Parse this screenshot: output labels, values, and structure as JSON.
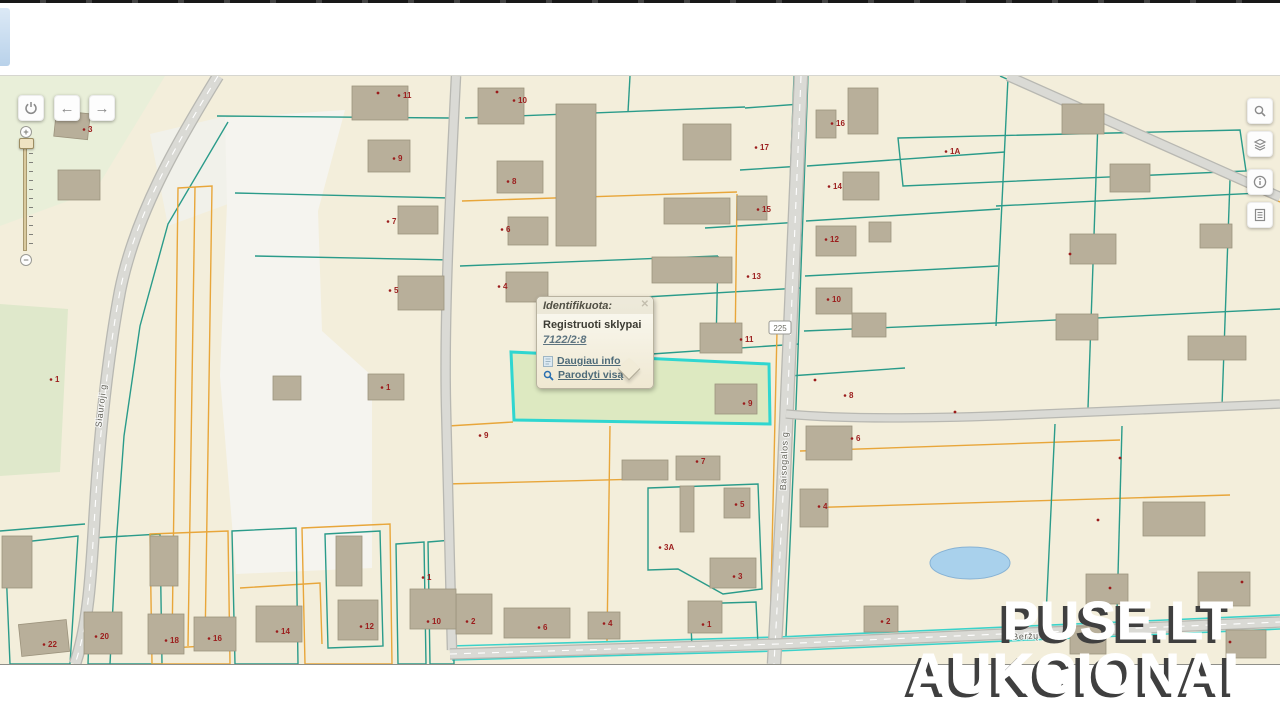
{
  "popup": {
    "title": "Identifikuota:",
    "close_label": "✕",
    "layer_name": "Registruoti sklypai",
    "parcel_id": "7122/2:8",
    "links": [
      {
        "icon": "page-info-icon",
        "label": "Daugiau info"
      },
      {
        "icon": "magnifier-icon",
        "label": "Parodyti visą"
      }
    ]
  },
  "watermark": {
    "line1": "PUSE.LT",
    "line2": "AUKCIONAI"
  },
  "controls": {
    "nav_buttons": [
      {
        "icon": "power-icon"
      },
      {
        "icon": "arrow-left-icon"
      },
      {
        "icon": "arrow-right-icon"
      }
    ],
    "zoom_slider": {
      "plus_label": "+",
      "minus_label": "−"
    },
    "right_toolbar": [
      {
        "icon": "search-icon"
      },
      {
        "icon": "layers-icon"
      },
      {
        "icon": "info-icon"
      },
      {
        "icon": "results-list-icon"
      }
    ]
  },
  "map": {
    "street_labels": [
      {
        "t": "Siauroji g",
        "x": 104,
        "y": 330,
        "r": -83
      },
      {
        "t": "Baisogalos g",
        "x": 787,
        "y": 385,
        "r": -88
      },
      {
        "t": "Beržų g",
        "x": 1030,
        "y": 563,
        "r": -3
      }
    ],
    "road_shield": {
      "t": "225",
      "x": 780,
      "y": 252
    },
    "selected_parcel_id": "7122/2:8"
  },
  "colors": {
    "base": "#f3eedb",
    "teal": "#2a9b8a",
    "orange": "#e8a63a",
    "cyan": "#3bd2ca",
    "road_fill": "#dadad5",
    "road_edge": "#b8b8b2",
    "building": "#b8af9a",
    "building_stroke": "#9c937d",
    "number": "#9b1c1c",
    "selection_fill": "#d8e7bc",
    "selection_stroke": "#2fd6d0",
    "pond": "#a9d1ec"
  },
  "map_geometry": {
    "zones": [
      {
        "points": "0,0 165,0 95,115 0,150",
        "fill": "#e9efd9"
      },
      {
        "points": "0,228 68,233 60,396 0,400",
        "fill": "#dfe8cb"
      },
      {
        "points": "150,58 226,40 228,128 168,150",
        "fill": "#f1f1ea"
      },
      {
        "points": "225,42 345,34 318,135 322,255 372,300 372,492 236,498 220,300 227,128",
        "fill": "#f5f4ef"
      }
    ],
    "parcels": [
      {
        "points": "898,62 1240,54 1246,95 903,110",
        "c": "teal"
      },
      {
        "points": "648,412 758,408 762,513 723,518 678,493 648,494",
        "c": "teal"
      },
      {
        "points": "690,528 756,526 758,569 692,571",
        "c": "teal"
      },
      {
        "points": "325,458 380,455 383,570 328,572",
        "c": "teal"
      },
      {
        "points": "178,112 212,110 205,570 172,572",
        "c": "orange"
      },
      {
        "points": "5,468 78,460 70,588 10,588",
        "c": "teal"
      },
      {
        "points": "92,462 160,458 162,588 88,588",
        "c": "teal"
      },
      {
        "points": "150,458 228,455 230,588 152,588",
        "c": "orange"
      },
      {
        "points": "232,455 296,452 298,588 235,588",
        "c": "teal"
      },
      {
        "points": "302,452 390,448 392,588 305,588",
        "c": "orange"
      },
      {
        "points": "396,468 424,466 426,588 398,588",
        "c": "teal"
      },
      {
        "points": "428,466 452,464 454,588 430,588",
        "c": "teal"
      }
    ],
    "lines": [
      {
        "p": "807,90 1005,76"
      },
      {
        "p": "806,145 1000,133"
      },
      {
        "p": "805,200 998,190"
      },
      {
        "p": "804,255 995,247"
      },
      {
        "p": "1008,2 996,250"
      },
      {
        "p": "996,130 1280,116"
      },
      {
        "p": "995,247 1280,233"
      },
      {
        "p": "745,32 801,28"
      },
      {
        "p": "740,94 802,90"
      },
      {
        "p": "705,152 801,146"
      },
      {
        "p": "645,221 800,212"
      },
      {
        "p": "622,280 799,268"
      },
      {
        "p": "737,118 735,276",
        "c": "orange"
      },
      {
        "p": "465,42 745,31"
      },
      {
        "p": "462,125 737,116",
        "c": "orange"
      },
      {
        "p": "460,190 718,180"
      },
      {
        "p": "630,0 628,36"
      },
      {
        "p": "718,180 716,268"
      },
      {
        "p": "448,350 513,346",
        "c": "orange"
      },
      {
        "p": "610,350 607,565",
        "c": "orange"
      },
      {
        "p": "446,408 645,403",
        "c": "orange"
      },
      {
        "p": "240,512 320,507 322,568",
        "c": "orange"
      },
      {
        "p": "195,111 188,570",
        "c": "orange"
      },
      {
        "p": "794,0 782,330 777,570"
      },
      {
        "p": "808,0 796,330 786,560"
      },
      {
        "p": "777,255 770,560",
        "c": "orange"
      },
      {
        "p": "789,300 905,292"
      },
      {
        "p": "800,375 1120,364",
        "c": "orange"
      },
      {
        "p": "800,432 1230,419",
        "c": "orange"
      },
      {
        "p": "1122,350 1117,536"
      },
      {
        "p": "1055,348 1046,540"
      },
      {
        "p": "1098,44 1088,332"
      },
      {
        "p": "1230,104 1222,330"
      },
      {
        "p": "1012,6 1280,126",
        "c": "orange"
      },
      {
        "p": "1000,0 1274,120"
      },
      {
        "p": "217,40 450,42"
      },
      {
        "p": "235,117 450,122"
      },
      {
        "p": "255,180 452,184"
      },
      {
        "p": "228,46 168,148 140,250 124,360 116,470 110,588"
      },
      {
        "p": "450,570 778,561 1280,539",
        "c": "cyan"
      },
      {
        "p": "452,584 778,575 1280,553",
        "c": "cyan"
      },
      {
        "p": "0,455 85,448"
      }
    ],
    "roads": [
      {
        "d": "M218,0 C175,70 135,140 120,215 C106,290 98,380 94,450 C91,500 88,550 75,588",
        "w": 10,
        "center": true
      },
      {
        "d": "M456,0 C450,120 444,240 446,330 C448,420 450,500 452,574",
        "w": 8,
        "center": false
      },
      {
        "d": "M801,0 C795,150 789,300 783,420 C779,500 776,550 774,588",
        "w": 12,
        "center": true
      },
      {
        "d": "M450,578 L778,568 C950,560 1120,553 1280,546",
        "w": 9,
        "center": true
      },
      {
        "d": "M786,338 C850,344 950,342 1020,339 C1120,335 1220,330 1280,328",
        "w": 7,
        "center": false
      },
      {
        "d": "M1008,0 L1280,121",
        "w": 8,
        "center": false
      }
    ],
    "pond": {
      "cx": 970,
      "cy": 487,
      "rx": 40,
      "ry": 16
    },
    "selection": {
      "points": "511,276 769,288 770,348 514,344"
    },
    "buildings": [
      [
        55,
        36,
        34,
        26,
        6
      ],
      [
        58,
        94,
        42,
        30,
        0
      ],
      [
        352,
        10,
        56,
        34,
        0
      ],
      [
        478,
        12,
        46,
        36,
        0
      ],
      [
        556,
        28,
        40,
        142,
        0
      ],
      [
        368,
        64,
        42,
        32,
        0
      ],
      [
        497,
        85,
        46,
        32,
        0
      ],
      [
        398,
        130,
        40,
        28,
        0
      ],
      [
        508,
        141,
        40,
        28,
        0
      ],
      [
        398,
        200,
        46,
        34,
        0
      ],
      [
        506,
        196,
        42,
        30,
        0
      ],
      [
        683,
        48,
        48,
        36,
        0
      ],
      [
        664,
        122,
        66,
        26,
        0
      ],
      [
        737,
        120,
        30,
        24,
        0
      ],
      [
        652,
        181,
        80,
        26,
        0
      ],
      [
        700,
        247,
        42,
        30,
        0
      ],
      [
        848,
        12,
        30,
        46,
        0
      ],
      [
        816,
        34,
        20,
        28,
        0
      ],
      [
        843,
        96,
        36,
        28,
        0
      ],
      [
        816,
        150,
        40,
        30,
        0
      ],
      [
        869,
        146,
        22,
        20,
        0
      ],
      [
        816,
        212,
        36,
        26,
        0
      ],
      [
        852,
        237,
        34,
        24,
        0
      ],
      [
        1062,
        28,
        42,
        30,
        0
      ],
      [
        1110,
        88,
        40,
        28,
        0
      ],
      [
        1070,
        158,
        46,
        30,
        0
      ],
      [
        1056,
        238,
        42,
        26,
        0
      ],
      [
        1188,
        260,
        58,
        24,
        0
      ],
      [
        1200,
        148,
        32,
        24,
        0
      ],
      [
        715,
        308,
        42,
        30,
        0
      ],
      [
        806,
        350,
        46,
        34,
        0
      ],
      [
        800,
        413,
        28,
        38,
        0
      ],
      [
        676,
        380,
        44,
        24,
        0
      ],
      [
        622,
        384,
        46,
        20,
        0
      ],
      [
        724,
        412,
        26,
        30,
        0
      ],
      [
        680,
        410,
        14,
        46,
        0
      ],
      [
        710,
        482,
        46,
        30,
        0
      ],
      [
        688,
        525,
        34,
        32,
        0
      ],
      [
        456,
        518,
        36,
        40,
        0
      ],
      [
        504,
        532,
        66,
        30,
        0
      ],
      [
        588,
        536,
        32,
        27,
        0
      ],
      [
        368,
        298,
        36,
        26,
        0
      ],
      [
        273,
        300,
        28,
        24,
        0
      ],
      [
        20,
        546,
        48,
        32,
        -6
      ],
      [
        84,
        536,
        38,
        42,
        0
      ],
      [
        148,
        538,
        36,
        40,
        0
      ],
      [
        194,
        541,
        42,
        34,
        0
      ],
      [
        256,
        530,
        46,
        36,
        0
      ],
      [
        338,
        524,
        40,
        40,
        0
      ],
      [
        410,
        513,
        46,
        40,
        0
      ],
      [
        2,
        460,
        30,
        52,
        0
      ],
      [
        150,
        460,
        28,
        50,
        0
      ],
      [
        336,
        460,
        26,
        50,
        0
      ],
      [
        864,
        530,
        34,
        26,
        0
      ],
      [
        1143,
        426,
        62,
        34,
        0
      ],
      [
        1086,
        498,
        42,
        30,
        0
      ],
      [
        1198,
        496,
        52,
        34,
        0
      ],
      [
        1226,
        554,
        40,
        28,
        0
      ],
      [
        1070,
        550,
        36,
        28,
        0
      ]
    ],
    "numbers": [
      {
        "t": "3",
        "x": 88,
        "y": 52
      },
      {
        "t": "11",
        "x": 403,
        "y": 18
      },
      {
        "t": "10",
        "x": 518,
        "y": 23
      },
      {
        "t": "9",
        "x": 398,
        "y": 81
      },
      {
        "t": "8",
        "x": 512,
        "y": 104
      },
      {
        "t": "7",
        "x": 392,
        "y": 144
      },
      {
        "t": "6",
        "x": 506,
        "y": 152
      },
      {
        "t": "5",
        "x": 394,
        "y": 213
      },
      {
        "t": "4",
        "x": 503,
        "y": 209
      },
      {
        "t": "17",
        "x": 760,
        "y": 70
      },
      {
        "t": "15",
        "x": 762,
        "y": 132
      },
      {
        "t": "13",
        "x": 752,
        "y": 199
      },
      {
        "t": "11",
        "x": 745,
        "y": 262
      },
      {
        "t": "16",
        "x": 836,
        "y": 46
      },
      {
        "t": "14",
        "x": 833,
        "y": 109
      },
      {
        "t": "12",
        "x": 830,
        "y": 162
      },
      {
        "t": "10",
        "x": 832,
        "y": 222
      },
      {
        "t": "1A",
        "x": 950,
        "y": 74
      },
      {
        "t": "1",
        "x": 55,
        "y": 302
      },
      {
        "t": "1",
        "x": 386,
        "y": 310
      },
      {
        "t": "9",
        "x": 484,
        "y": 358
      },
      {
        "t": "9",
        "x": 748,
        "y": 326
      },
      {
        "t": "3A",
        "x": 664,
        "y": 470
      },
      {
        "t": "7",
        "x": 701,
        "y": 384
      },
      {
        "t": "5",
        "x": 740,
        "y": 427
      },
      {
        "t": "3",
        "x": 738,
        "y": 499
      },
      {
        "t": "1",
        "x": 707,
        "y": 547
      },
      {
        "t": "2",
        "x": 471,
        "y": 544
      },
      {
        "t": "6",
        "x": 543,
        "y": 550
      },
      {
        "t": "4",
        "x": 608,
        "y": 546
      },
      {
        "t": "22",
        "x": 48,
        "y": 567
      },
      {
        "t": "20",
        "x": 100,
        "y": 559
      },
      {
        "t": "18",
        "x": 170,
        "y": 563
      },
      {
        "t": "16",
        "x": 213,
        "y": 561
      },
      {
        "t": "14",
        "x": 281,
        "y": 554
      },
      {
        "t": "12",
        "x": 365,
        "y": 549
      },
      {
        "t": "10",
        "x": 432,
        "y": 544
      },
      {
        "t": "1",
        "x": 427,
        "y": 500
      },
      {
        "t": "8",
        "x": 849,
        "y": 318
      },
      {
        "t": "6",
        "x": 856,
        "y": 361
      },
      {
        "t": "4",
        "x": 823,
        "y": 429
      },
      {
        "t": "2",
        "x": 886,
        "y": 544
      }
    ],
    "dots": [
      [
        1070,
        178
      ],
      [
        1120,
        382
      ],
      [
        1242,
        506
      ],
      [
        1110,
        512
      ],
      [
        955,
        336
      ],
      [
        815,
        304
      ],
      [
        1098,
        444
      ],
      [
        1230,
        566
      ],
      [
        378,
        17
      ],
      [
        497,
        16
      ]
    ]
  }
}
